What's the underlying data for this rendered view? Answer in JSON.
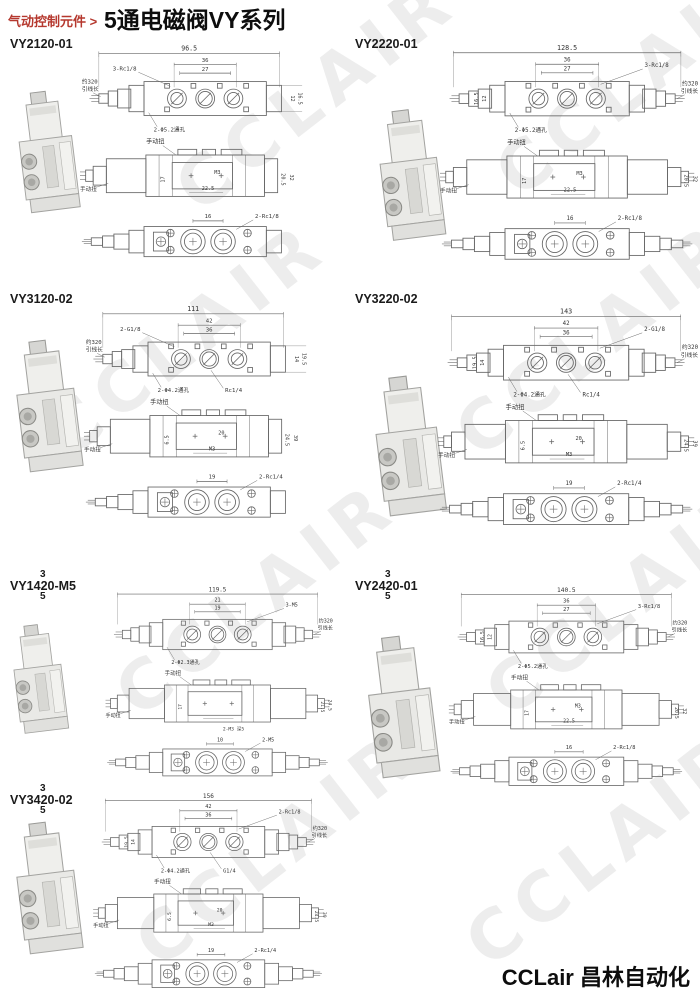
{
  "header": {
    "breadcrumb": "气动控制元件 >",
    "title": "5通电磁阀VY系列"
  },
  "footer": {
    "brand": "CCLair 昌林自动化"
  },
  "watermark": "CCLAIR",
  "colors": {
    "accent_red": "#b5382e",
    "drawing_line": "#666666",
    "dim_text": "#333333"
  },
  "sections": [
    {
      "model": "VY2120-01",
      "type": "single",
      "wire_side": "left",
      "wire": {
        "l1": "约320",
        "l2": "引线长"
      },
      "manual": "手动扭",
      "top": {
        "total": "96.5",
        "d1": "36",
        "d2": "27",
        "ports": "3-Rc1/8",
        "holes": "2-Φ5.2通孔",
        "side1": "16.5",
        "side2": "12"
      },
      "side": {
        "in1": "M3",
        "in2": "22.5",
        "v1": "17",
        "v2": "20.5",
        "v3": "32"
      },
      "bottom": {
        "w": "16",
        "ports": "2-Rc1/8"
      }
    },
    {
      "model": "VY2220-01",
      "type": "double",
      "wire_side": "right",
      "wire": {
        "l1": "约320",
        "l2": "引线长"
      },
      "manual": "手动扭",
      "top": {
        "total": "128.5",
        "d1": "36",
        "d2": "27",
        "ports": "3-Rc1/8",
        "holes": "2-Φ5.2通孔",
        "side1": "16.5",
        "side2": "12"
      },
      "side": {
        "in1": "M3",
        "in2": "22.5",
        "v1": "17",
        "v2": "20.5",
        "v3": "32"
      },
      "bottom": {
        "w": "16",
        "ports": "2-Rc1/8"
      }
    },
    {
      "model": "VY3120-02",
      "type": "single",
      "wire_side": "left",
      "wire": {
        "l1": "约320",
        "l2": "引线长"
      },
      "manual": "手动扭",
      "top": {
        "total": "111",
        "d1": "42",
        "d2": "36",
        "ports": "2-G1/8",
        "holes": "2-Φ4.2通孔",
        "extra": "Rc1/4",
        "side1": "19.5",
        "side2": "14"
      },
      "side": {
        "in1": "20",
        "in2": "M3",
        "v1": "6.5",
        "v2": "24.5",
        "v3": "39"
      },
      "bottom": {
        "w": "19",
        "ports": "2-Rc1/4"
      }
    },
    {
      "model": "VY3220-02",
      "type": "double",
      "wire_side": "right",
      "wire": {
        "l1": "约320",
        "l2": "引线长"
      },
      "manual": "手动扭",
      "top": {
        "total": "143",
        "d1": "42",
        "d2": "36",
        "ports": "2-G1/8",
        "holes": "2-Φ4.2通孔",
        "extra": "Rc1/4",
        "side1": "19.5",
        "side2": "14"
      },
      "side": {
        "in1": "20",
        "in2": "M3",
        "v1": "6.5",
        "v2": "24.5",
        "v3": "39"
      },
      "bottom": {
        "w": "19",
        "ports": "2-Rc1/4"
      }
    },
    {
      "model": "VY1420-M5",
      "sup": "3",
      "sub": "5",
      "type": "double",
      "wire_side": "right",
      "wire": {
        "l1": "约320",
        "l2": "引线长"
      },
      "manual": "手动扭",
      "top": {
        "total": "119.5",
        "d1": "21",
        "d2": "19",
        "ports": "3-M5",
        "holes": "2-Φ2.3通孔"
      },
      "side": {
        "v1": "17",
        "v2": "21.5",
        "v3": "24.5",
        "extra": "2-M3 深5"
      },
      "bottom": {
        "w": "10",
        "ports": "2-M5"
      }
    },
    {
      "model": "VY2420-01",
      "sup": "3",
      "sub": "5",
      "type": "double",
      "wire_side": "right",
      "wire": {
        "l1": "约320",
        "l2": "引线长"
      },
      "manual": "手动扭",
      "top": {
        "total": "140.5",
        "d1": "36",
        "d2": "27",
        "ports": "3-Rc1/8",
        "holes": "2-Φ5.2通孔",
        "side1": "16.5",
        "side2": "12"
      },
      "side": {
        "in1": "M3",
        "in2": "22.5",
        "v1": "17",
        "v2": "20.5",
        "v3": "32"
      },
      "bottom": {
        "w": "16",
        "ports": "2-Rc1/8"
      }
    },
    {
      "model": "VY3420-02",
      "sup": "3",
      "sub": "5",
      "type": "double",
      "wire_side": "right",
      "wire": {
        "l1": "约320",
        "l2": "引线长"
      },
      "manual": "手动扭",
      "top": {
        "total": "156",
        "d1": "42",
        "d2": "36",
        "ports": "2-Rc1/8",
        "holes": "2-Φ4.2通孔",
        "extra": "G1/4",
        "side1": "19.5",
        "side2": "14"
      },
      "side": {
        "in1": "20",
        "in2": "M3",
        "v1": "6.5",
        "v2": "24.5",
        "v3": "39"
      },
      "bottom": {
        "w": "19",
        "ports": "2-Rc1/4"
      }
    }
  ]
}
